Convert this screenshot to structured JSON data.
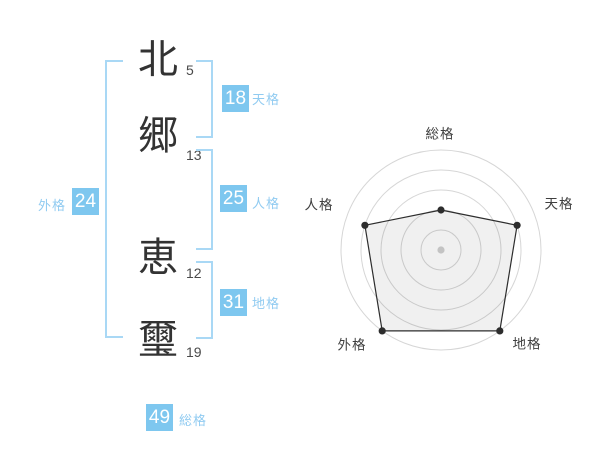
{
  "name": {
    "chars": [
      {
        "char": "北",
        "strokes": "5"
      },
      {
        "char": "郷",
        "strokes": "13"
      },
      {
        "char": "恵",
        "strokes": "12"
      },
      {
        "char": "璽",
        "strokes": "19"
      }
    ]
  },
  "kaku": {
    "ten": {
      "value": "18",
      "label": "天格"
    },
    "jin": {
      "value": "25",
      "label": "人格"
    },
    "chi": {
      "value": "31",
      "label": "地格"
    },
    "gai": {
      "value": "24",
      "label": "外格"
    },
    "sou": {
      "value": "49",
      "label": "総格"
    }
  },
  "colors": {
    "badge_bg": "#7EC7EF",
    "label_text": "#90CBF1",
    "bracket": "#A9D8F5",
    "ink": "#333333",
    "stroke_text": "#4a4a4a",
    "ring": "#D6D6D6",
    "polygon_line": "#2D2D2D",
    "polygon_fill": "rgba(0,0,0,0.06)",
    "center_dot": "#C3C3C3",
    "axis_label": "#3F3F3F"
  },
  "chart_data": {
    "type": "radar",
    "axes": [
      "総格",
      "天格",
      "地格",
      "外格",
      "人格"
    ],
    "values": [
      2,
      4,
      5,
      5,
      4
    ],
    "max": 5,
    "rings": 5,
    "grid": "concentric-circles",
    "legend": "none"
  }
}
